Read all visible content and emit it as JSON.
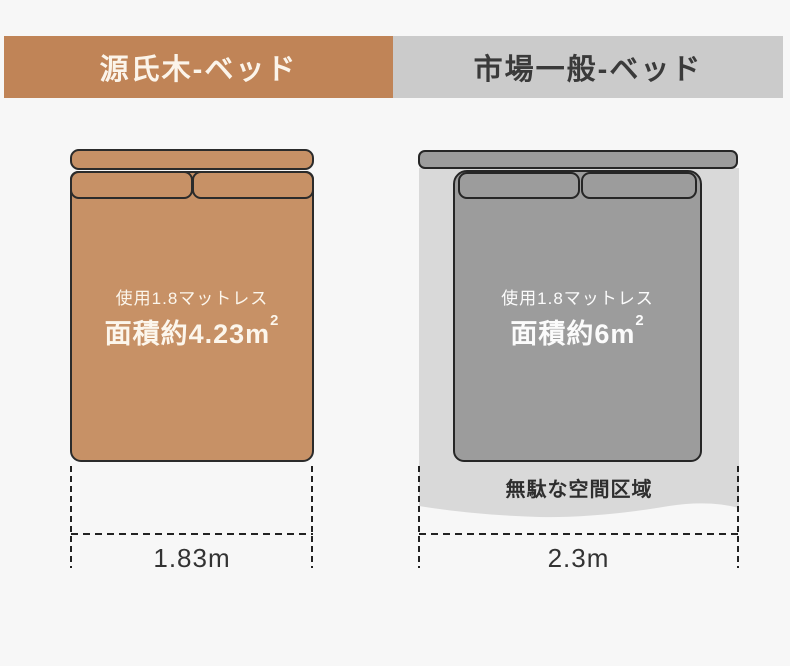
{
  "left_panel": {
    "header": "源氏木-ベッド",
    "note": "使用1.8マットレス",
    "area": "面積約4.23m",
    "area_exponent": "2",
    "width_label": "1.83m"
  },
  "right_panel": {
    "header": "市場一般-ベッド",
    "note": "使用1.8マットレス",
    "area": "面積約6m",
    "area_exponent": "2",
    "wasted_space_label": "無駄な空間区域",
    "width_label": "2.3m"
  },
  "colors": {
    "accent_orange": "#c08457",
    "bed_tan": "#c79166",
    "header_gray": "#cbcbcb",
    "bed_gray": "#9c9c9c",
    "wasted_gray": "#d9d9d9",
    "outline_dark": "#2b2b2b",
    "dim_text": "#333333",
    "background": "#f7f7f7"
  }
}
